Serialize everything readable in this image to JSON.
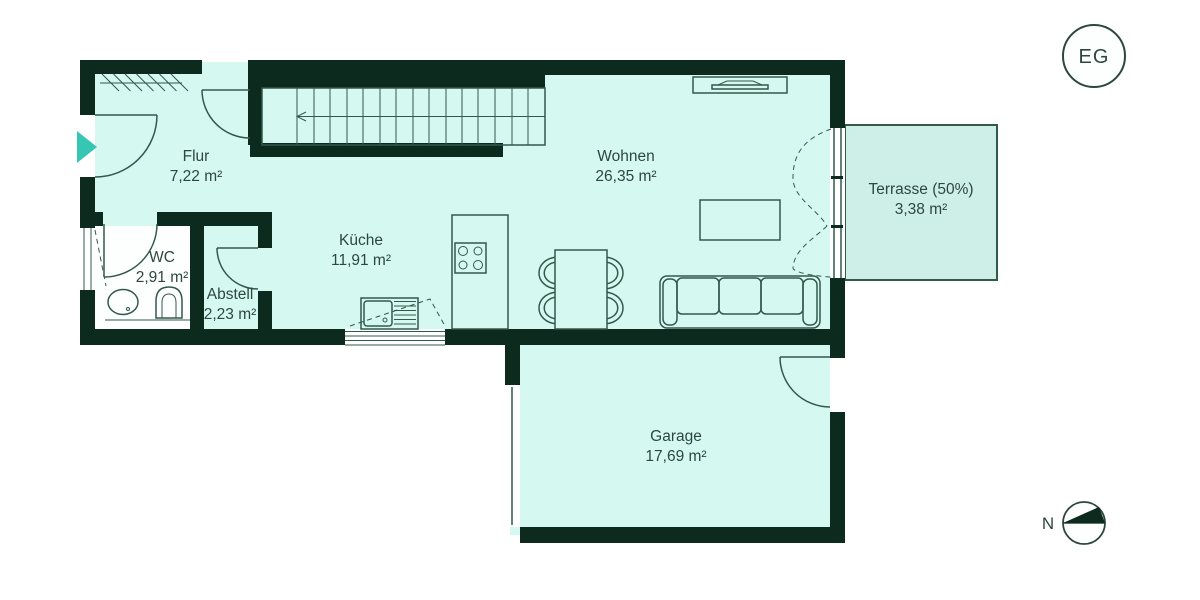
{
  "floor_plan": {
    "badge": {
      "label": "EG"
    },
    "compass": {
      "north_label": "N"
    },
    "rooms": [
      {
        "id": "flur",
        "name": "Flur",
        "area": "7,22 m²"
      },
      {
        "id": "wc",
        "name": "WC",
        "area": "2,91 m²"
      },
      {
        "id": "abstell",
        "name": "Abstell",
        "area": "2,23 m²"
      },
      {
        "id": "kueche",
        "name": "Küche",
        "area": "11,91 m²"
      },
      {
        "id": "wohnen",
        "name": "Wohnen",
        "area": "26,35 m²"
      },
      {
        "id": "terrasse",
        "name": "Terrasse (50%)",
        "area": "3,38 m²"
      },
      {
        "id": "garage",
        "name": "Garage",
        "area": "17,69 m²"
      }
    ],
    "colors": {
      "wall": "#0c2a1d",
      "floor": "#d5f8f0",
      "terrace_floor": "#cdefe7",
      "wc_floor": "#fdffff",
      "accent_teal": "#35c7b4",
      "line": "#33594c",
      "text": "#2d463e",
      "background": "#ffffff"
    }
  }
}
